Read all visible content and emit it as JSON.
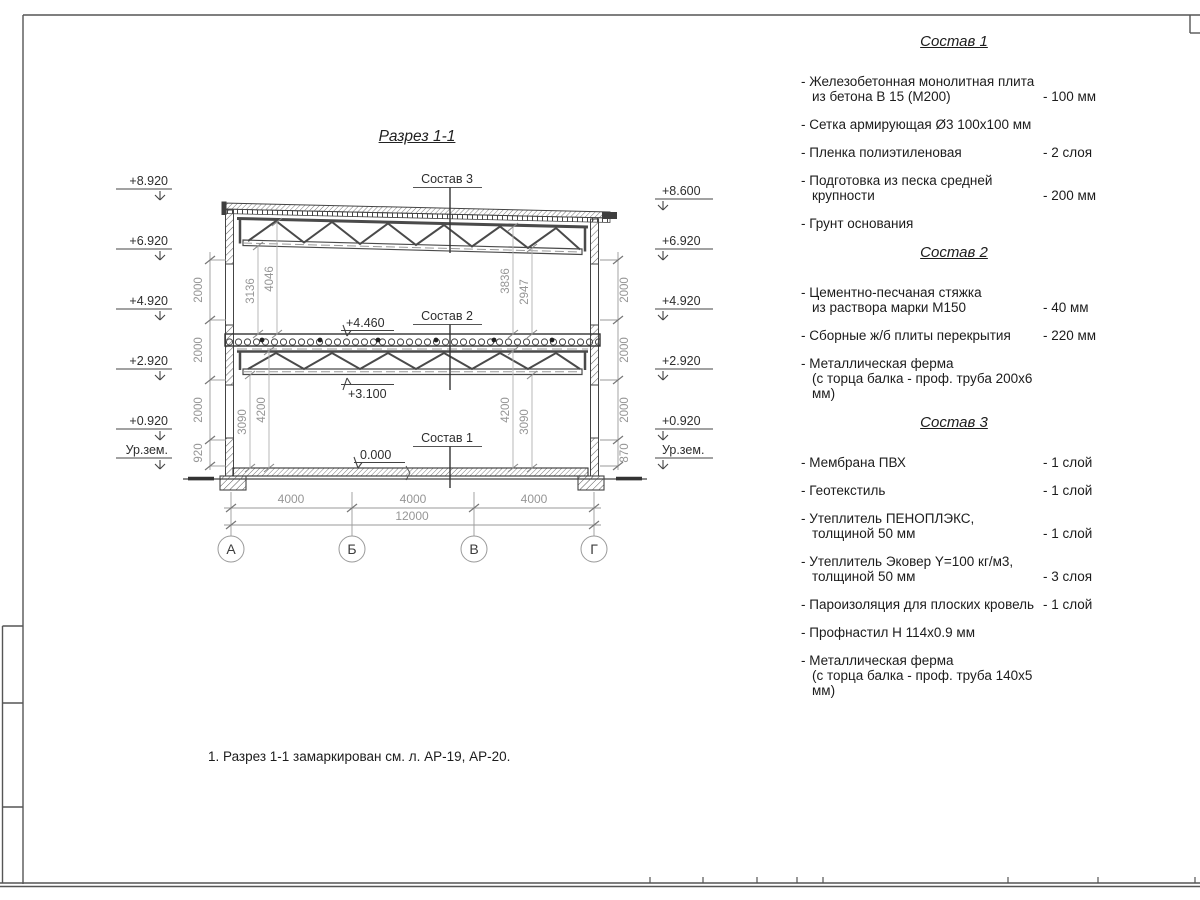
{
  "drawing": {
    "title": "Разрез 1-1",
    "callouts": {
      "c1": "Состав 1",
      "c2": "Состав 2",
      "c3": "Состав 3"
    },
    "level_marks": {
      "slab_top": "+4.460",
      "truss_bottom": "+3.100",
      "floor": "0.000"
    },
    "elevations_left": [
      "+8.920",
      "+6.920",
      "+4.920",
      "+2.920",
      "+0.920",
      "Ур.зем."
    ],
    "elevations_right": [
      "+8.600",
      "+6.920",
      "+4.920",
      "+2.920",
      "+0.920",
      "Ур.зем."
    ],
    "chain_left": [
      "2000",
      "2000",
      "2000",
      "920"
    ],
    "chain_right": [
      "2000",
      "2000",
      "2000",
      "870"
    ],
    "dims_upper_left": [
      "3136",
      "4046"
    ],
    "dims_upper_right": [
      "3836",
      "2947"
    ],
    "dims_lower_left": [
      "3090",
      "4200"
    ],
    "dims_lower_right": [
      "4200",
      "3090"
    ],
    "dims_span": [
      "4000",
      "4000",
      "4000"
    ],
    "dim_total": "12000",
    "axes": [
      "А",
      "Б",
      "В",
      "Г"
    ]
  },
  "compositions": [
    {
      "title": "Состав 1",
      "items": [
        {
          "text": "- Железобетонная  монолитная плита",
          "text2": "из бетона В 15 (М200)",
          "value": "- 100 мм"
        },
        {
          "text": "- Сетка армирующая Ø3 100х100 мм",
          "text2": "",
          "value": ""
        },
        {
          "text": "- Пленка полиэтиленовая",
          "text2": "",
          "value": "-  2 слоя"
        },
        {
          "text": "- Подготовка из песка средней",
          "text2": "крупности",
          "value": "- 200 мм"
        },
        {
          "text": "- Грунт основания",
          "text2": "",
          "value": ""
        }
      ]
    },
    {
      "title": "Состав 2",
      "items": [
        {
          "text": "- Цементно-песчаная стяжка",
          "text2": "из раствора марки М150",
          "value": "- 40 мм"
        },
        {
          "text": "- Сборные ж/б плиты перекрытия",
          "text2": "",
          "value": "- 220 мм"
        },
        {
          "text": "- Металлическая ферма",
          "text2": "(с торца балка - проф. труба 200х6 мм)",
          "value": ""
        }
      ]
    },
    {
      "title": "Состав 3",
      "items": [
        {
          "text": "- Мембрана ПВХ",
          "text2": "",
          "value": "- 1 слой"
        },
        {
          "text": "- Геотекстиль",
          "text2": "",
          "value": "- 1 слой"
        },
        {
          "text": "- Утеплитель ПЕНОПЛЭКС,",
          "text2": "толщиной 50 мм",
          "value": "- 1 слой"
        },
        {
          "text": "- Утеплитель Эковер Y=100 кг/м3,",
          "text2": "толщиной 50 мм",
          "value": "- 3 слоя"
        },
        {
          "text": "- Пароизоляция для плоских кровель",
          "text2": "",
          "value": "- 1 слой"
        },
        {
          "text": "- Профнастил Н 114х0.9 мм",
          "text2": "",
          "value": ""
        },
        {
          "text": "- Металлическая ферма",
          "text2": "(с торца балка - проф. труба 140х5 мм)",
          "value": ""
        }
      ]
    }
  ],
  "note": "1. Разрез 1-1 замаркирован см. л. АР-19, АР-20."
}
